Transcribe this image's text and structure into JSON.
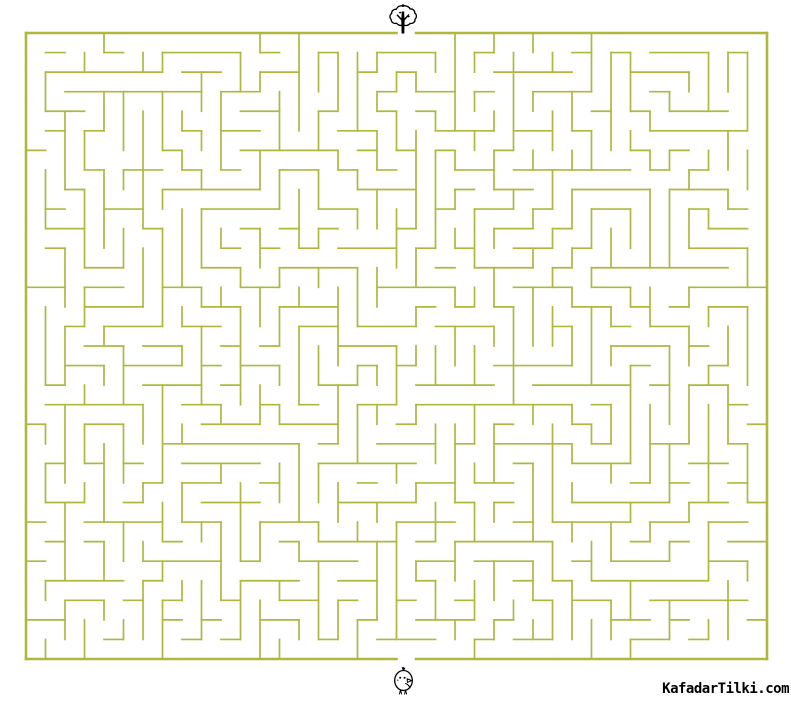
{
  "page": {
    "width": 791,
    "height": 702,
    "background": "#ffffff"
  },
  "branding": {
    "site_label": "KafadarTilki.com",
    "text_color": "#000000"
  },
  "maze": {
    "type": "maze-puzzle",
    "rows": 32,
    "cols": 38,
    "width": 741,
    "height": 626,
    "offset_x": 26,
    "offset_y": 33,
    "wall_color": "#aeb83f",
    "wall_thickness": 1.7,
    "border_thickness": 2.6,
    "background": "#ffffff",
    "entrance": {
      "side": "top",
      "col": 19,
      "icon": "tree-icon"
    },
    "exit": {
      "side": "bottom",
      "col": 19,
      "icon": "chick-icon"
    },
    "seed": 1337,
    "braid": 0.35
  },
  "icons": {
    "start": "tree-icon",
    "end": "chick-icon"
  }
}
